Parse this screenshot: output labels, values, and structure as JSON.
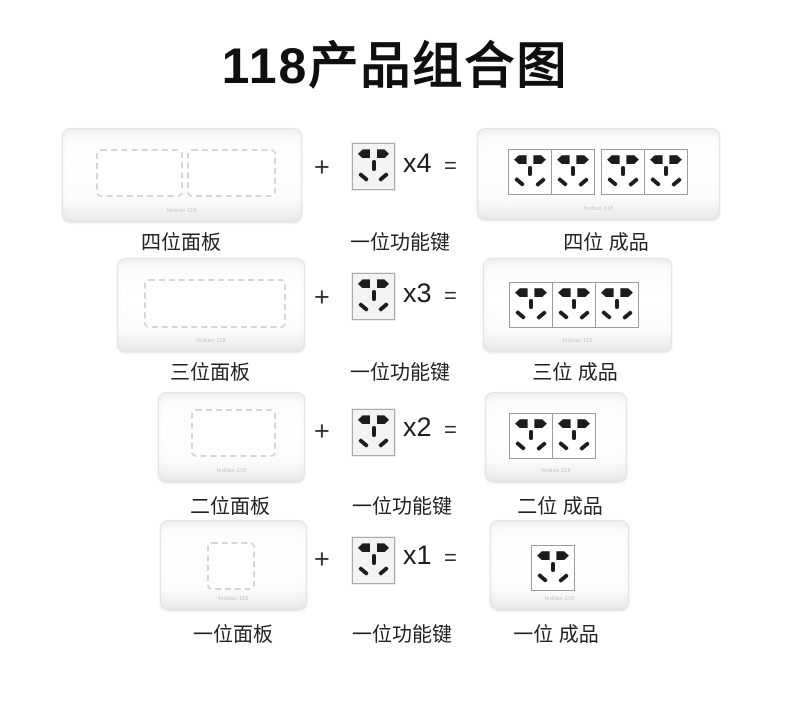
{
  "title": "118产品组合图",
  "brand_mark": "feidiao·118",
  "colors": {
    "background": "#ffffff",
    "title_text": "#0f0f0f",
    "label_text": "#222222",
    "plate_face": "#ffffff",
    "plate_border": "#e3e3e3",
    "opening_dash": "#d5d5d5",
    "module_face": "#f3f3f1",
    "module_border": "#ababab",
    "socket_hole": "#1c1c1c",
    "brand_text": "#bdbdbd"
  },
  "rows": [
    {
      "panel_label": "四位面板",
      "operator_plus": "+",
      "module_label": "一位功能键",
      "multiplier": "x4",
      "operator_equals": "=",
      "product_label": "四位 成品",
      "panel_openings": 2,
      "product_sockets": 4,
      "product_groups": [
        2,
        2
      ]
    },
    {
      "panel_label": "三位面板",
      "operator_plus": "+",
      "module_label": "一位功能键",
      "multiplier": "x3",
      "operator_equals": "=",
      "product_label": "三位 成品",
      "panel_openings": 1,
      "product_sockets": 3,
      "product_groups": [
        3
      ]
    },
    {
      "panel_label": "二位面板",
      "operator_plus": "+",
      "module_label": "一位功能键",
      "multiplier": "x2",
      "operator_equals": "=",
      "product_label": "二位 成品",
      "panel_openings": 1,
      "product_sockets": 2,
      "product_groups": [
        2
      ]
    },
    {
      "panel_label": "一位面板",
      "operator_plus": "+",
      "module_label": "一位功能键",
      "multiplier": "x1",
      "operator_equals": "=",
      "product_label": "一位 成品",
      "panel_openings": 1,
      "product_sockets": 1,
      "product_groups": [
        1
      ]
    }
  ]
}
